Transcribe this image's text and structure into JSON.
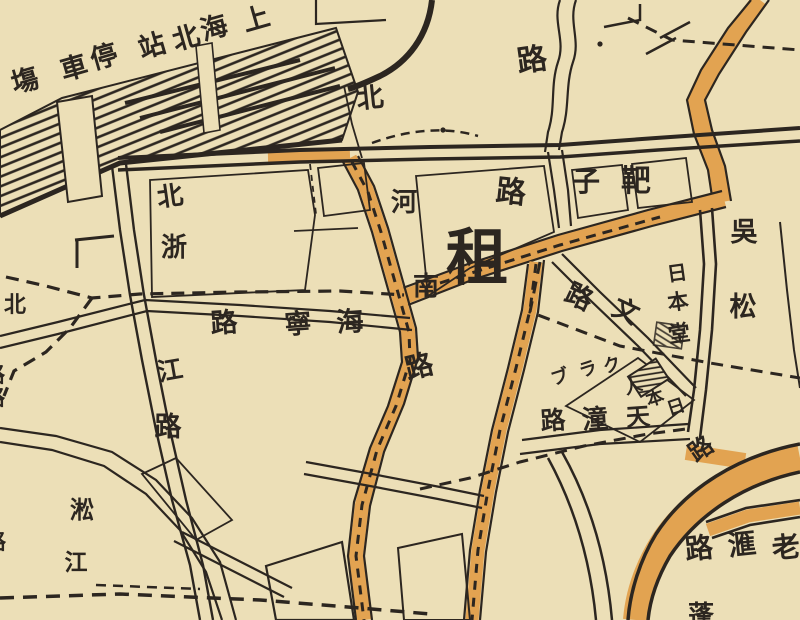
{
  "map": {
    "description": "Historical street map section, Shanghai North Station and Hongkou concession-boundary area",
    "colors": {
      "paper_background": "#ecdfb7",
      "ink": "#2c2620",
      "road_orange": "#e2a351"
    },
    "labels": {
      "station": {
        "text": "上海北站停車塲",
        "reading_direction": "right-to-left",
        "chars": [
          "塲",
          "車",
          "停",
          "站",
          "北",
          "海",
          "上"
        ]
      },
      "top_road": {
        "text": "路"
      },
      "north_henan_road": {
        "text": "北河南路",
        "reading_direction": "top-to-bottom",
        "chars": [
          "北",
          "河",
          "南",
          "路"
        ]
      },
      "bazi_road": {
        "text": "靶子路",
        "reading_direction": "right-to-left",
        "chars": [
          "路",
          "子",
          "靶"
        ]
      },
      "concession": {
        "text": "租"
      },
      "haining_road": {
        "text": "海寧路",
        "reading_direction": "right-to-left",
        "chars": [
          "路",
          "寧",
          "海"
        ]
      },
      "north_zhejiang_road": {
        "text": "北浙江路",
        "reading_direction": "top-to-bottom",
        "chars": [
          "北",
          "浙",
          "江",
          "路"
        ]
      },
      "wusong_road": {
        "text": "吳松",
        "reading_direction": "top-to-bottom",
        "chars": [
          "吳",
          "松"
        ]
      },
      "nihon_hall": {
        "text": "日本堂",
        "reading_direction": "top-to-bottom",
        "chars": [
          "日",
          "本",
          "堂"
        ]
      },
      "bun_road": {
        "text": "文路",
        "reading_direction": "right-to-left",
        "chars": [
          "路",
          "文"
        ]
      },
      "japan_club": {
        "text": "日本人クラブ",
        "reading_direction": "right-to-left",
        "chars": [
          "ブ",
          "ラ",
          "ク",
          "人",
          "本",
          "日"
        ]
      },
      "tiantong_road": {
        "text": "天潼路",
        "reading_direction": "right-to-left",
        "chars": [
          "路",
          "潼",
          "天"
        ]
      },
      "junction_road_char": {
        "text": "路"
      },
      "broadway_road": {
        "text": "老滙路",
        "reading_direction": "right-to-left",
        "chars": [
          "路",
          "滙",
          "老"
        ]
      },
      "songjiang": {
        "text": "淞江",
        "reading_direction": "top-to-bottom",
        "chars": [
          "淞",
          "江"
        ]
      },
      "edge_north": {
        "text": "北"
      },
      "edge_partial_1": {
        "text": "路"
      },
      "edge_partial_2": {
        "text": "路"
      },
      "edge_partial_3": {
        "text": "路"
      },
      "edge_partial_bottom": {
        "text": "蓬"
      }
    }
  }
}
